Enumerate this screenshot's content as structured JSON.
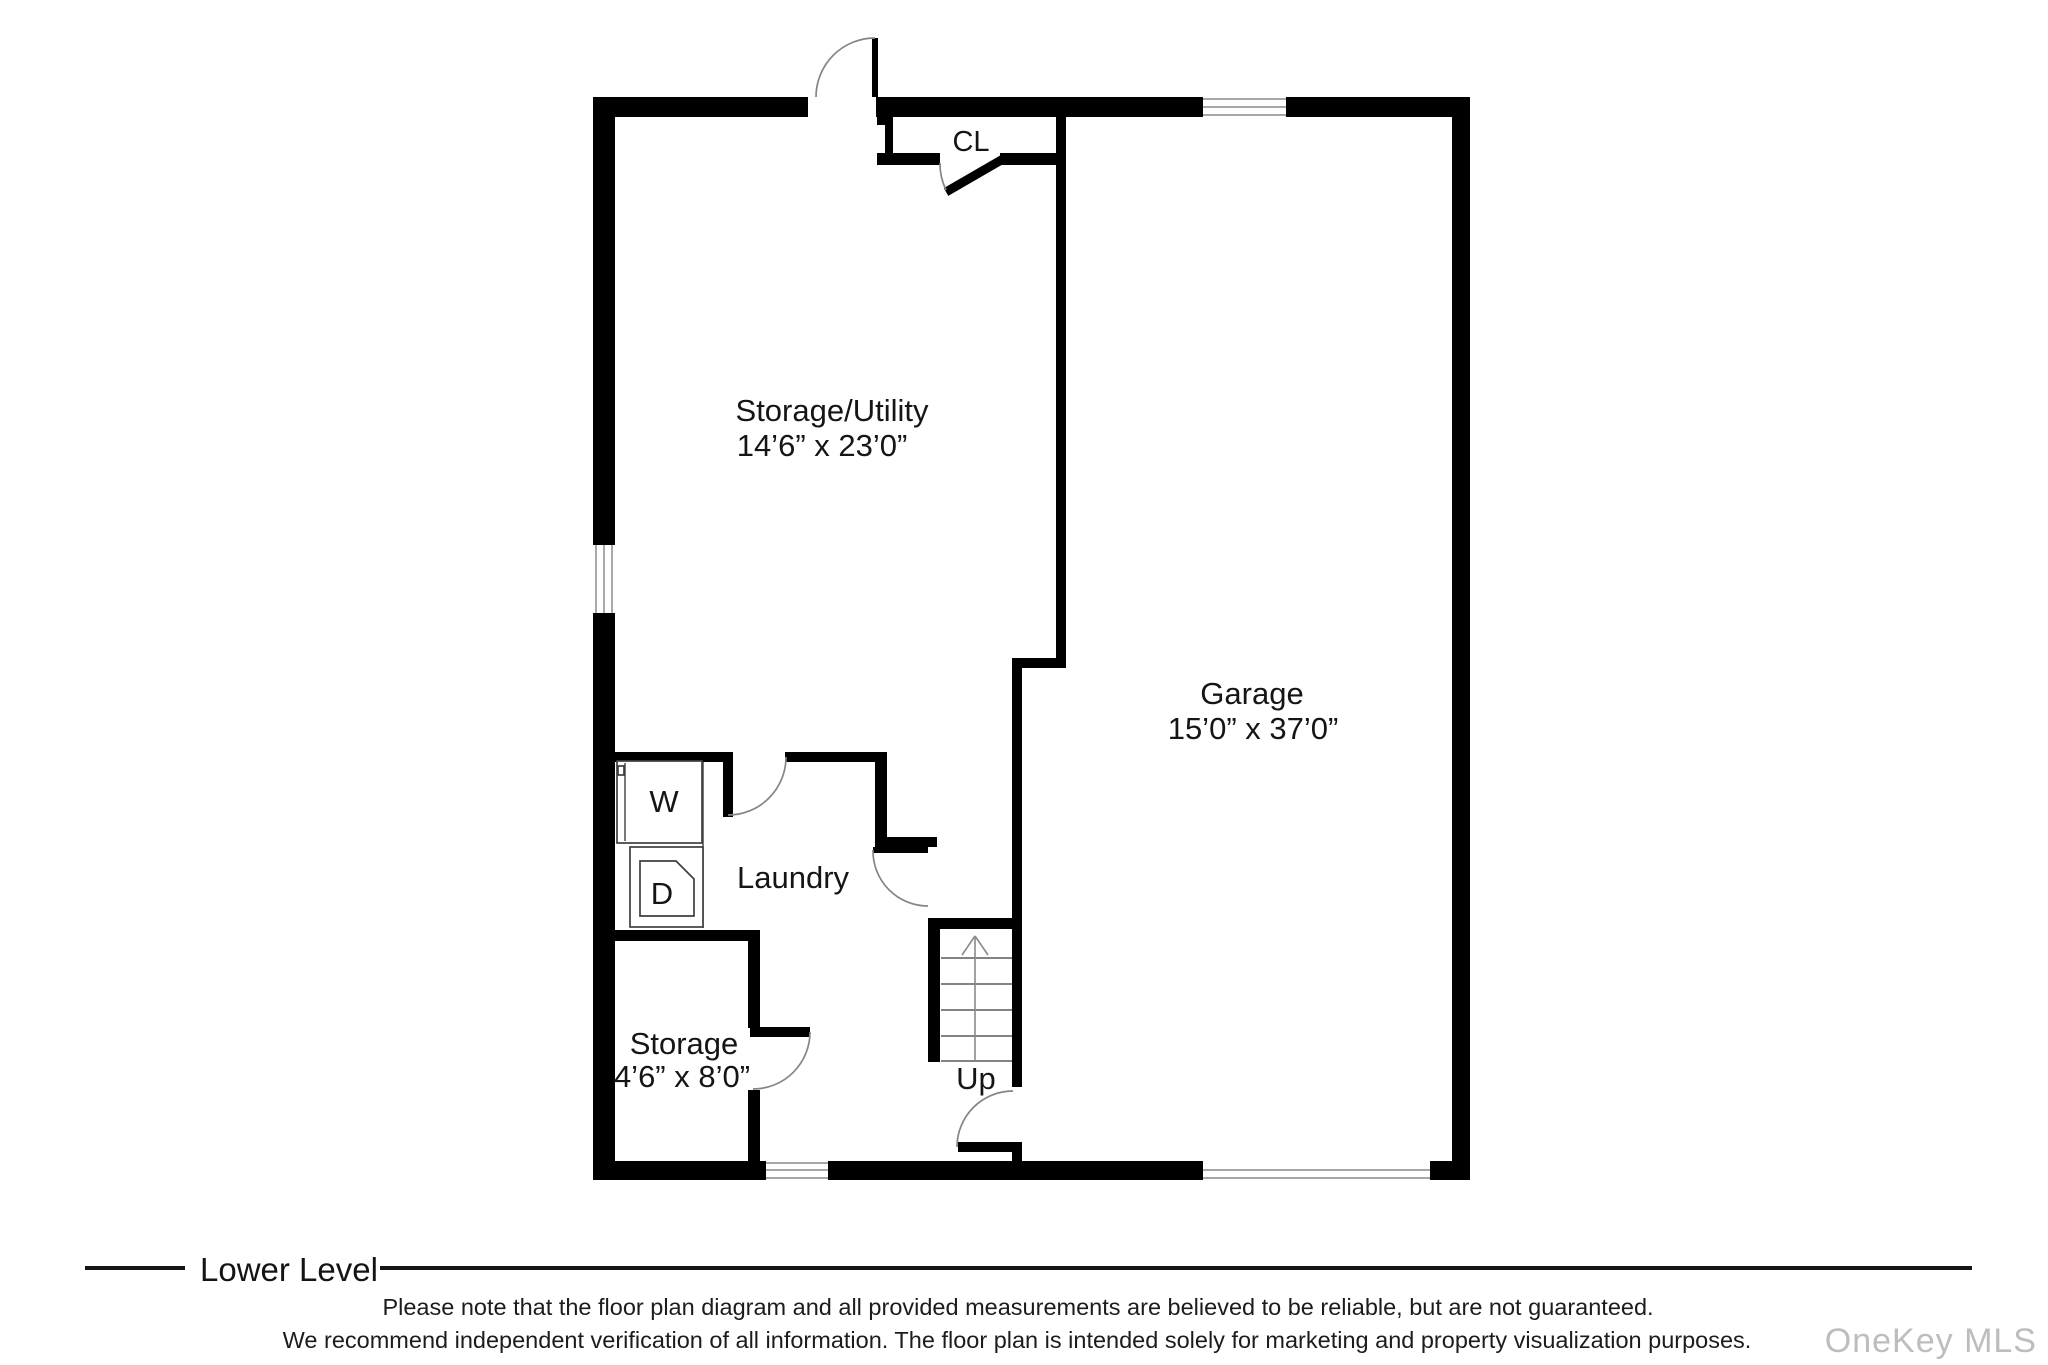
{
  "rooms": {
    "storage_utility": {
      "name": "Storage/Utility",
      "dims": "14’6” x 23’0”"
    },
    "garage": {
      "name": "Garage",
      "dims": "15’0” x 37’0”"
    },
    "laundry": {
      "name": "Laundry"
    },
    "storage": {
      "name": "Storage",
      "dims": "4’6” x 8’0”"
    },
    "closet": {
      "label": "CL"
    }
  },
  "appliances": {
    "washer": "W",
    "dryer": "D"
  },
  "stairs": {
    "direction": "Up"
  },
  "footer": {
    "level": "Lower Level",
    "disclaimer1": "Please note that the floor plan diagram and all provided measurements are believed to be reliable, but are not guaranteed.",
    "disclaimer2": "We recommend independent verification of all information. The floor plan is intended solely for marketing and property visualization purposes.",
    "watermark": "OneKey MLS"
  },
  "colors": {
    "wall": "#000000",
    "door_arc": "#858585",
    "text": "#151515",
    "watermark": "#bdbdbd"
  }
}
